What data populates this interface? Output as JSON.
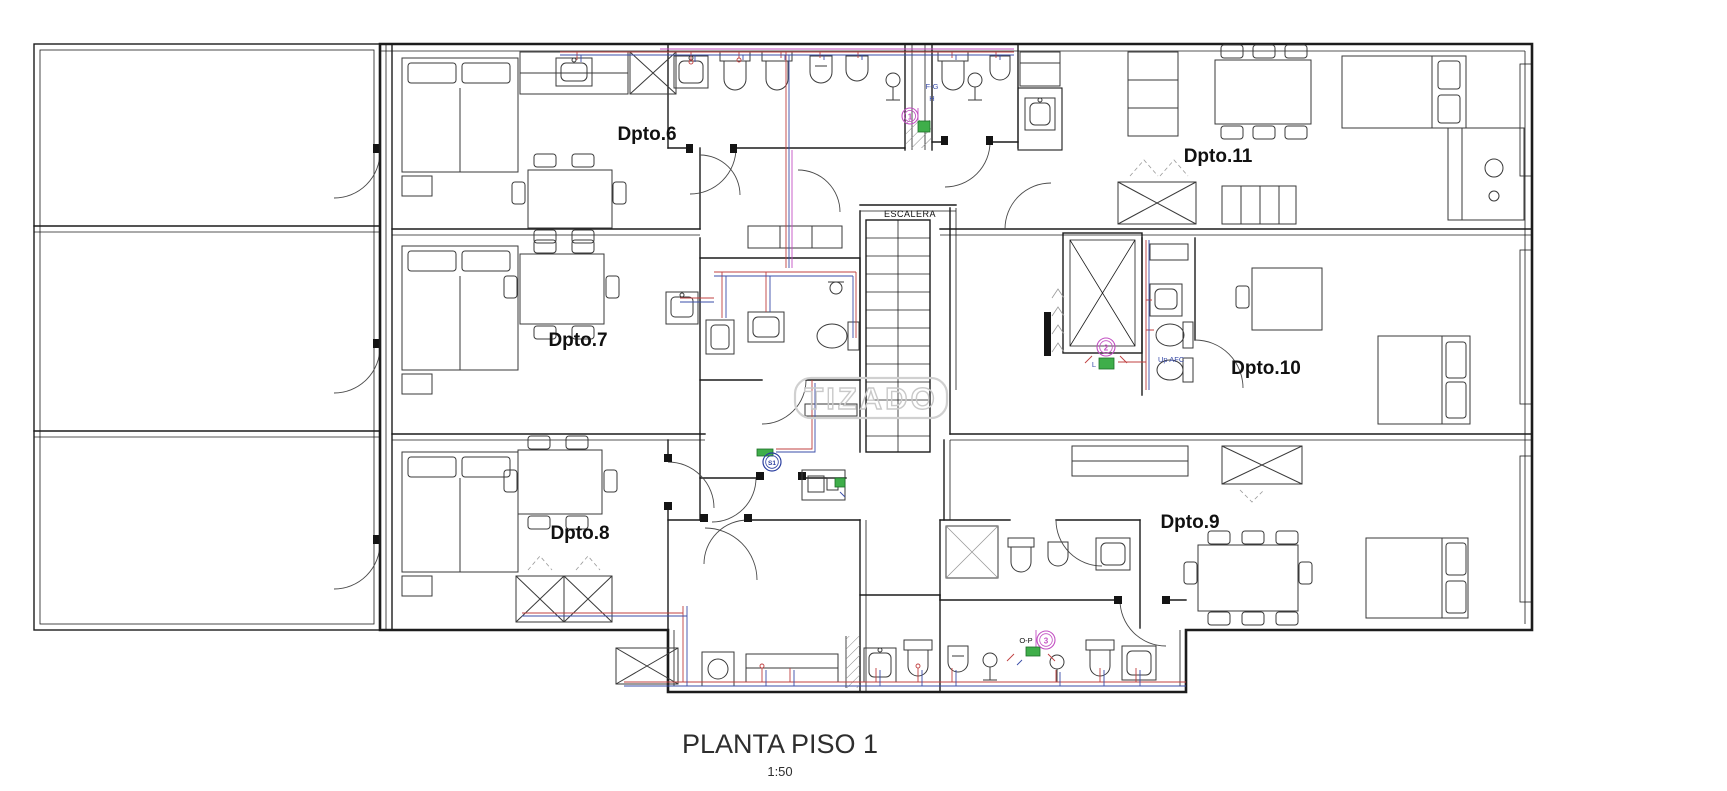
{
  "title": {
    "text": "PLANTA PISO 1",
    "scale": "1:50"
  },
  "watermark": {
    "text": "TIZADO"
  },
  "rooms": {
    "dpto6": "Dpto.6",
    "dpto7": "Dpto.7",
    "dpto8": "Dpto.8",
    "dpto9": "Dpto.9",
    "dpto10": "Dpto.10",
    "dpto11": "Dpto.11",
    "escalera": "ESCALERA"
  },
  "markers": {
    "riser_1": "1",
    "riser_2": "2",
    "riser_3": "3",
    "sanitary": "S1",
    "duct_fg": "F-G",
    "duct_h": "H",
    "meter_l": "L",
    "up_afc": "Up AFC",
    "duct_op": "O-P"
  },
  "legend_colors": {
    "wall": "#1c1c1c",
    "hot_water": "#c04040",
    "cold_water": "#3a4da8",
    "vent_line": "#c24fc2",
    "gas_meter_green": "#3fae4a",
    "watermark_gray": "#c9c9c9"
  }
}
